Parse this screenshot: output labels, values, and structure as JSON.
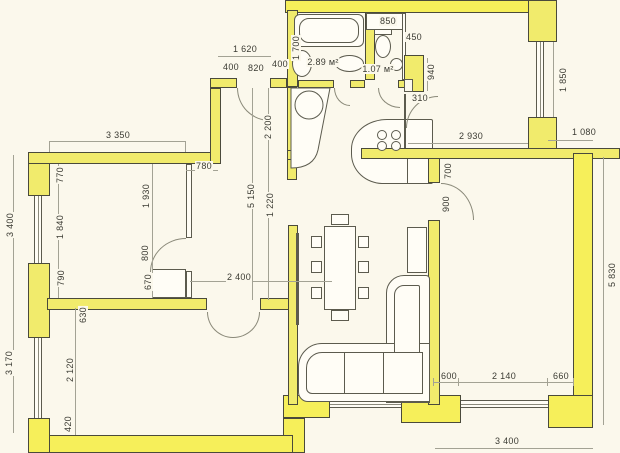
{
  "drawing": {
    "type": "apartment-floor-plan",
    "units": "mm",
    "room_area_labels": [
      "2.89 м²",
      "1.07 м²"
    ]
  },
  "colors": {
    "paper": "#fbf8ec",
    "wall_fill": "#f1eb6c",
    "wall_bright": "#f6ef5a",
    "wall_edge": "#4a4a3b",
    "line": "#5c5b4e",
    "dim_line": "#a3a294",
    "dim_text": "#3b3b33"
  },
  "labels": [
    {
      "text": "1 620",
      "x": 245,
      "y": 49
    },
    {
      "text": "400",
      "x": 231,
      "y": 67
    },
    {
      "text": "820",
      "x": 256,
      "y": 68
    },
    {
      "text": "400",
      "x": 280,
      "y": 64
    },
    {
      "text": "1 700",
      "x": 296,
      "y": 48,
      "v": true
    },
    {
      "text": "850",
      "x": 388,
      "y": 21
    },
    {
      "text": "450",
      "x": 414,
      "y": 37
    },
    {
      "text": "2.89 м²",
      "x": 323,
      "y": 62
    },
    {
      "text": "1.07 м²",
      "x": 378,
      "y": 69
    },
    {
      "text": "940",
      "x": 431,
      "y": 72,
      "v": true
    },
    {
      "text": "310",
      "x": 420,
      "y": 98
    },
    {
      "text": "1 850",
      "x": 563,
      "y": 80,
      "v": true
    },
    {
      "text": "1 080",
      "x": 584,
      "y": 132
    },
    {
      "text": "2 930",
      "x": 471,
      "y": 136
    },
    {
      "text": "700",
      "x": 448,
      "y": 171,
      "v": true
    },
    {
      "text": "900",
      "x": 446,
      "y": 204,
      "v": true
    },
    {
      "text": "2 200",
      "x": 268,
      "y": 127,
      "v": true
    },
    {
      "text": "5 150",
      "x": 251,
      "y": 196,
      "v": true
    },
    {
      "text": "1 220",
      "x": 270,
      "y": 205,
      "v": true
    },
    {
      "text": "3 350",
      "x": 118,
      "y": 135
    },
    {
      "text": "780",
      "x": 204,
      "y": 166
    },
    {
      "text": "770",
      "x": 60,
      "y": 175,
      "v": true
    },
    {
      "text": "1 930",
      "x": 146,
      "y": 196,
      "v": true
    },
    {
      "text": "1 840",
      "x": 60,
      "y": 227,
      "v": true
    },
    {
      "text": "3 400",
      "x": 10,
      "y": 225,
      "v": true
    },
    {
      "text": "800",
      "x": 145,
      "y": 253,
      "v": true
    },
    {
      "text": "790",
      "x": 61,
      "y": 278,
      "v": true
    },
    {
      "text": "670",
      "x": 148,
      "y": 282,
      "v": true
    },
    {
      "text": "2 400",
      "x": 239,
      "y": 277
    },
    {
      "text": "630",
      "x": 83,
      "y": 315,
      "v": true
    },
    {
      "text": "2 120",
      "x": 70,
      "y": 370,
      "v": true
    },
    {
      "text": "3 170",
      "x": 9,
      "y": 363,
      "v": true
    },
    {
      "text": "420",
      "x": 68,
      "y": 424,
      "v": true
    },
    {
      "text": "600",
      "x": 449,
      "y": 376
    },
    {
      "text": "2 140",
      "x": 504,
      "y": 376
    },
    {
      "text": "660",
      "x": 561,
      "y": 376
    },
    {
      "text": "3 400",
      "x": 507,
      "y": 441
    },
    {
      "text": "5 830",
      "x": 612,
      "y": 275,
      "v": true
    }
  ]
}
